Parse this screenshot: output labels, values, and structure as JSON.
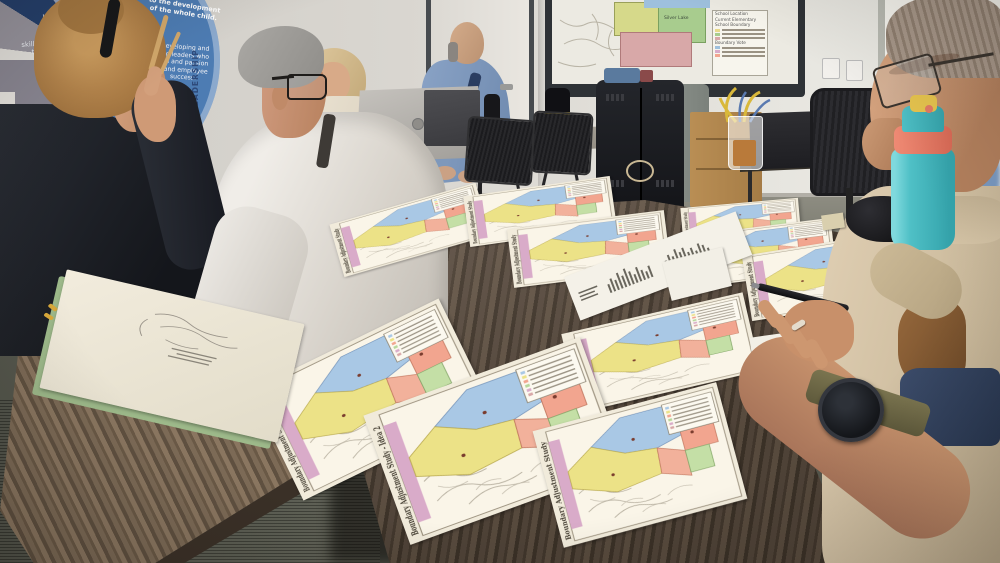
{
  "banner": {
    "top_lines": [
      "to the development",
      "of the whole child."
    ],
    "left_lines": [
      "Identify",
      "and prov",
      "requisite",
      "skills and pers",
      "that lead st",
      "toward suc",
      "participat"
    ],
    "right_lines": [
      "Developing and",
      "ing leaders who",
      "ion and passion",
      "t and employee",
      "success."
    ],
    "vertical_label": "LEADERSHIP",
    "ribbon_text": "DISTRICT CU",
    "arc_fragment": "e school an"
  },
  "projection_screen": {
    "region_label": "Silver Lake",
    "legend_item_school": "School Location",
    "legend_header_current_1": "Current Elementary",
    "legend_header_current_2": "School Boundary",
    "legend_header_vote": "Boundary Vote"
  },
  "map_sheets": [
    {
      "title": "Boundary Adjustment Study"
    },
    {
      "title": "Boundary Adjustment Study"
    },
    {
      "title": "Boundary Adjustment Study"
    },
    {
      "title": "Boundary Adjustment Study"
    },
    {
      "title": "Boundary Adjustment Study"
    },
    {
      "title": "Boundary Adjustment Study"
    },
    {
      "title": "Boundary Adjustment Study - Idea 3"
    },
    {
      "title": "Boundary Adjustment Study - Idea 1"
    },
    {
      "title": "Boundary Adjustment Study - Idea 2"
    },
    {
      "title": "Boundary Adjustment Study"
    }
  ],
  "colors": {
    "map_blue": "#a9c8e5",
    "map_yellow": "#ece287",
    "map_salmon": "#f2a58f",
    "map_green": "#b7d79b",
    "map_purple": "#d9abc9",
    "map_paper": "#f1ebdb",
    "table_wood": "#5f5043",
    "bottle_teal": "#4fc0c6",
    "bottle_coral": "#e27a65",
    "banner_blue": "#4d7cb3",
    "banner_gray": "#8b8894",
    "ribbon_navy": "#24406e"
  }
}
